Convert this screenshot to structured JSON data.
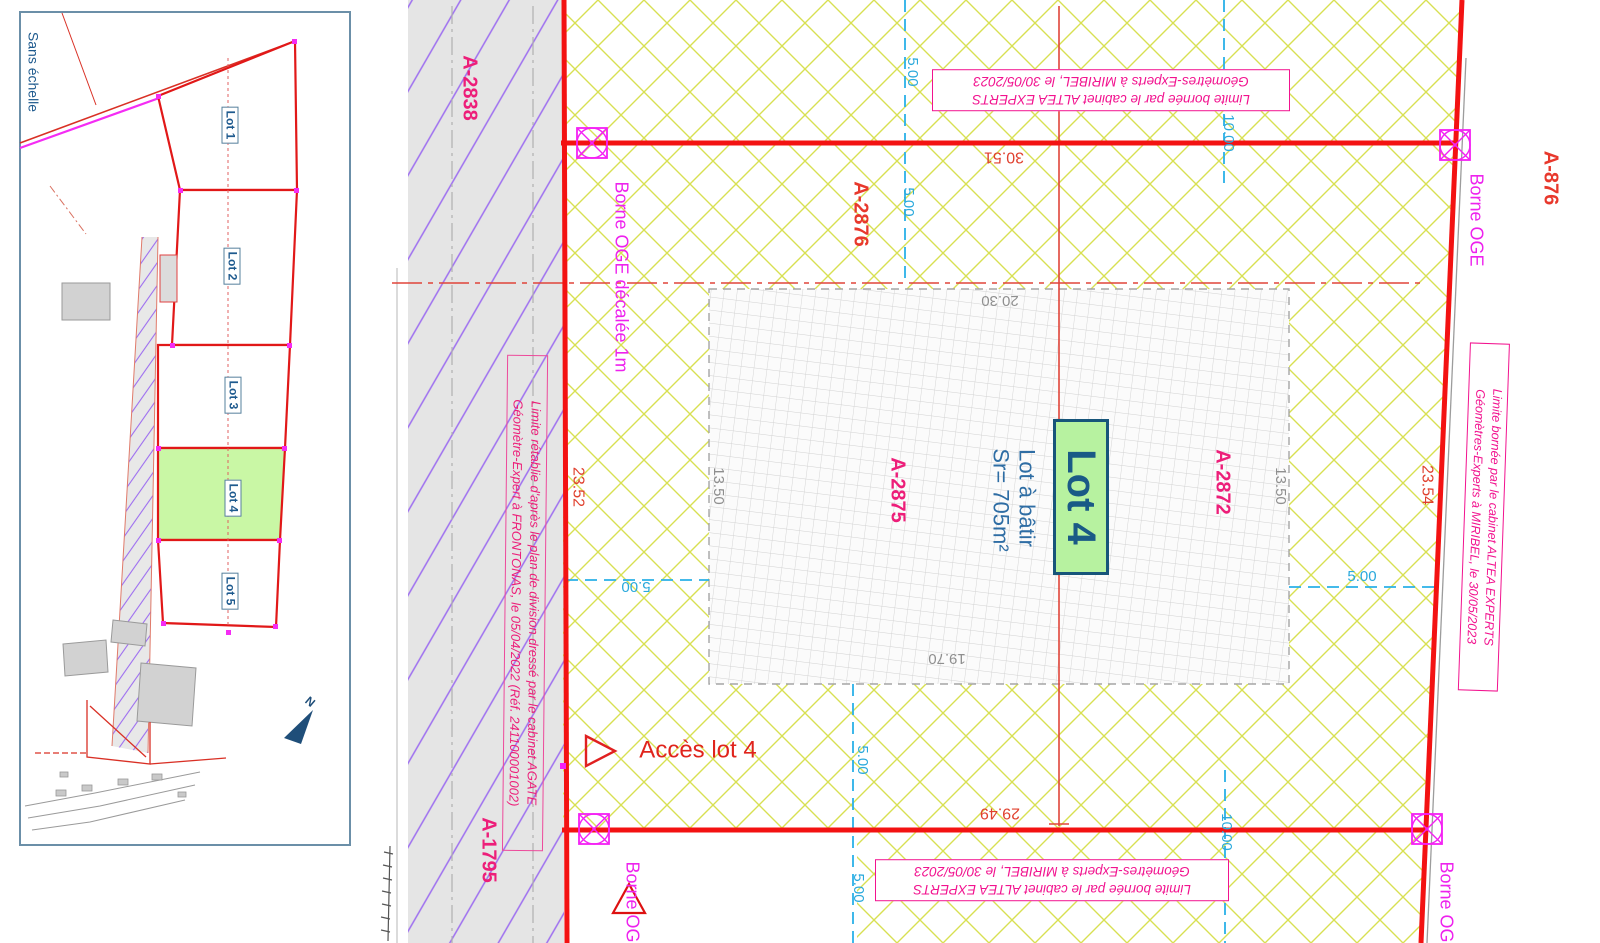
{
  "inset": {
    "scale_note": "Sans échelle",
    "lots": [
      "Lot 1",
      "Lot 2",
      "Lot 3",
      "Lot 4",
      "Lot 5"
    ],
    "north_label": "N"
  },
  "parcels": {
    "a2838": "A-2838",
    "a1795": "A-1795",
    "a2876": "A-2876",
    "a2875": "A-2875",
    "a2872": "A-2872",
    "a876": "A-876"
  },
  "lot": {
    "name": "Lot 4",
    "type": "Lot à bâtir",
    "area": "Sr= 705m²"
  },
  "dims": {
    "top": "30.51",
    "bottom": "29.49",
    "left": "23.52",
    "right": "23.54",
    "bldg_top": "20.30",
    "bldg_bottom": "19.70",
    "bldg_side": "13.50"
  },
  "offsets": {
    "five": "5.00",
    "ten": "10.00"
  },
  "bornes": {
    "oge": "Borne OGE",
    "oge_offset": "Borne OGE décalée 1m"
  },
  "notes": {
    "altea_line1": "Limite bornée par le cabinet ALTEA EXPERTS",
    "altea_line2": "Géomètres-Experts à MIRIBEL, le 30/05/2023",
    "agate_line1": "Limite rétablie d'après le plan de division dressé par le cabinet AGATE",
    "agate_line2": "Géomètre-Expert à FRONTONAS, le 05/04/2022 (Réf. 241100001002)"
  },
  "access": {
    "label": "Accès lot 4"
  },
  "colors": {
    "boundary_red": "#f31212",
    "hatch_green": "#d8e052",
    "road_purple": "#9d6ef0",
    "magenta": "#ee22ee",
    "note_pink": "#f2138f",
    "parcel_pink": "#ed1e79",
    "cyan": "#2aa9dc",
    "lot_green_fill": "#b7f2a0",
    "label_blue": "#1e5a8e"
  }
}
